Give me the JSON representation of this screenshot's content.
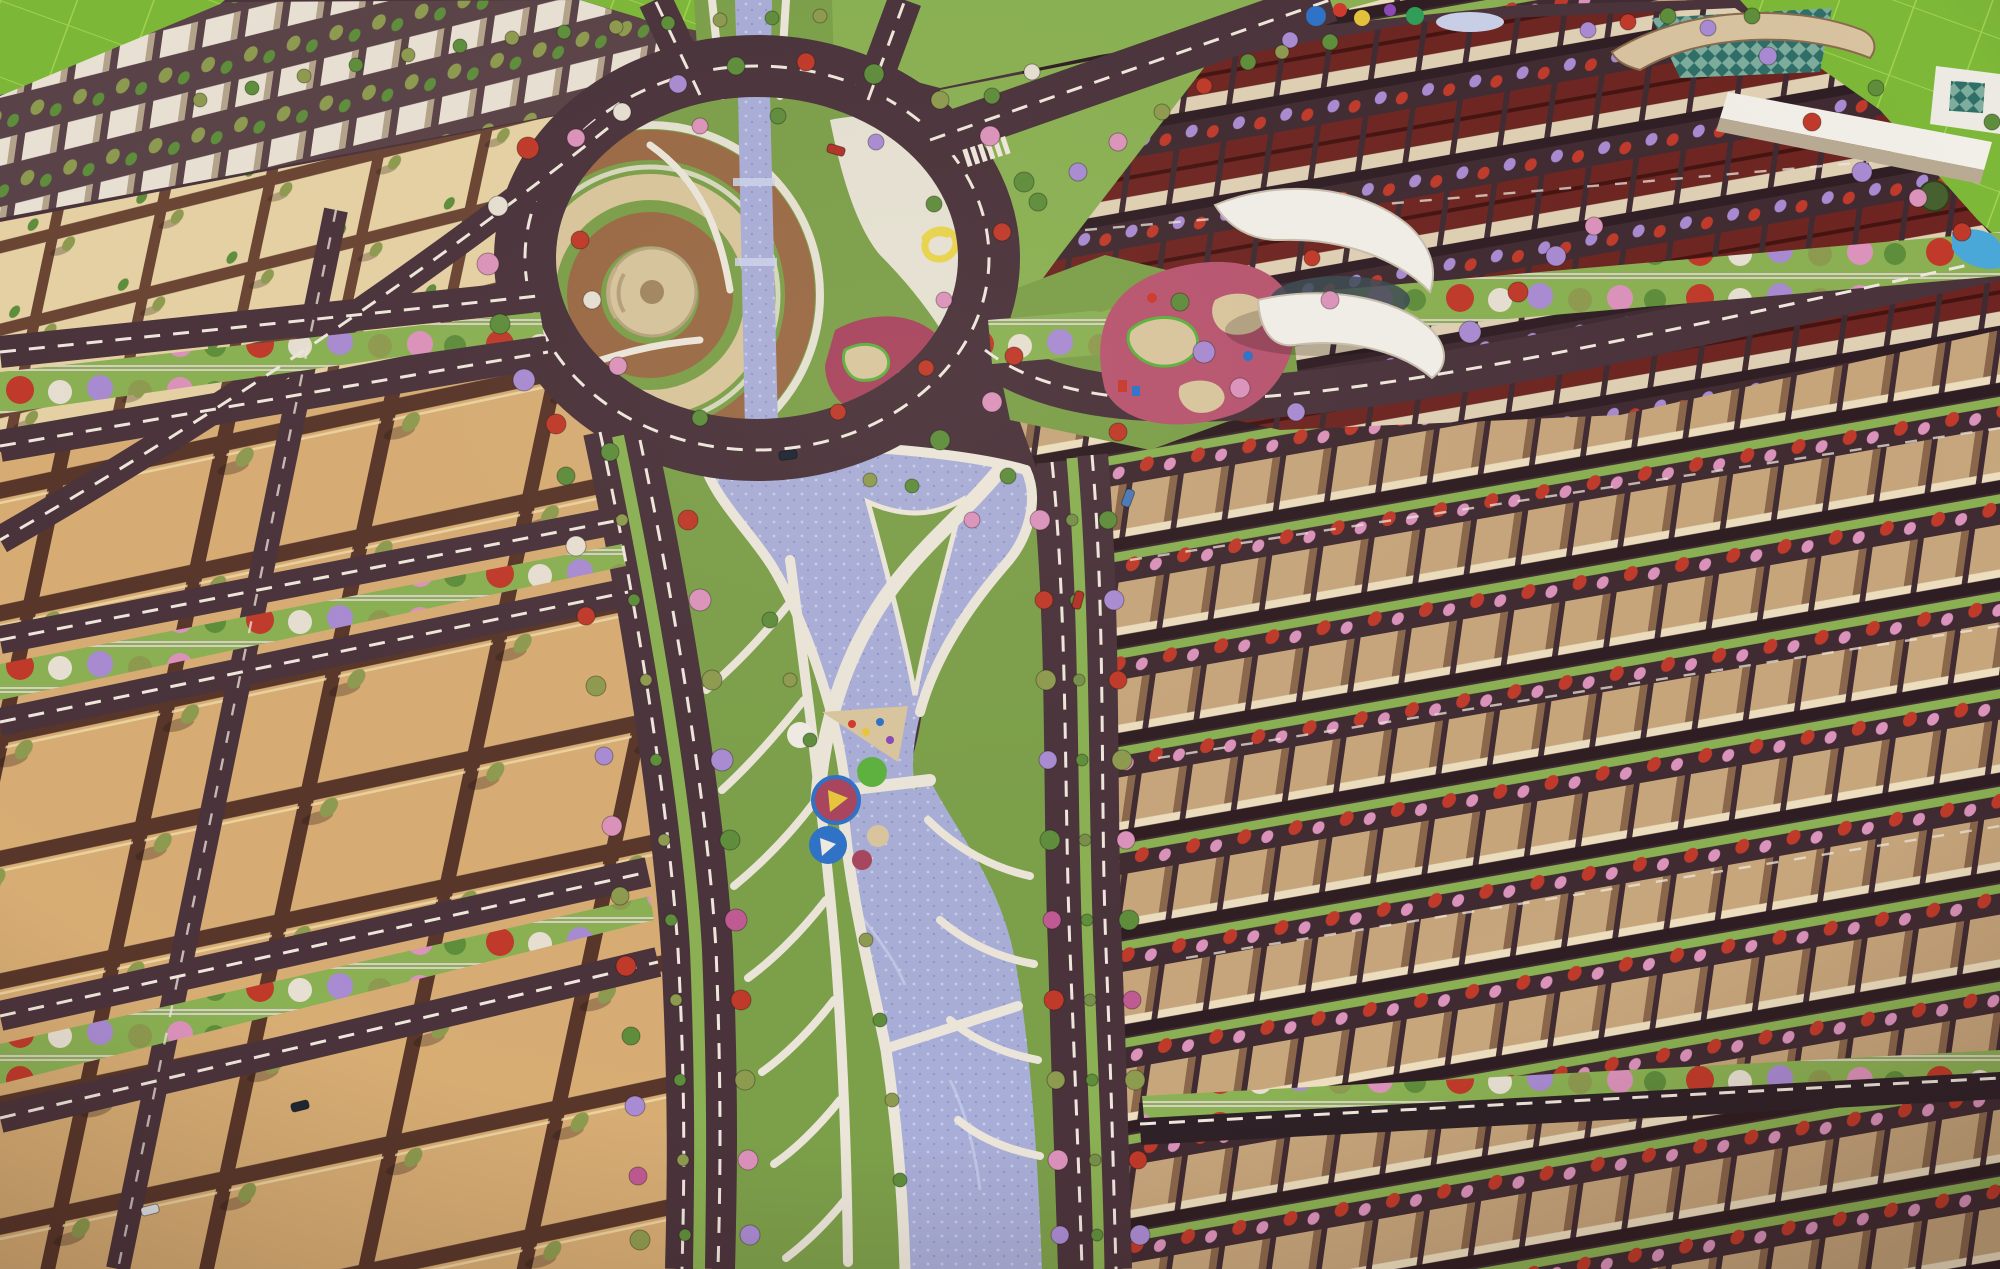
{
  "description": "Aerial 3D master-plan render of a township: central landscaped roundabout park crossed by a winding blue canal with white promenades, empty tan plot grids on the left, rows of flat-roofed tan villas on the right, red-roofed townhouses and a curved-canopy clubhouse at top right, green fields in the corners, tree-lined boulevards with flowering red, pink and purple trees.",
  "palette": {
    "road": "#4a333b",
    "roadDark": "#2e2127",
    "street": "#402b32",
    "dash": "#efe7dd",
    "plotTan": "#d7ad74",
    "plotLine": "#58362a",
    "plotLight": "#e6d2a4",
    "plotLineLight": "#6b4534",
    "canal": "#a9aed8",
    "canalLight": "#ced3ec",
    "canalDeep": "#8e94c6",
    "park": "#7ca04a",
    "lawn": "#8ab153",
    "field": "#7db838",
    "fieldLine": "#a3d24f",
    "pathWhite": "#ece6da",
    "ringBrown": "#9a6a45",
    "ringTan": "#d9c69c",
    "playMaroon": "#a8455f",
    "playPink": "#b85570",
    "sand": "#d9c69e",
    "playGreen": "#5cb23e",
    "villaRoof": "#c7a67c",
    "villaDark": "#8a674b",
    "villaFace": "#ecdebf",
    "roofRed": "#6e2521",
    "roofRedDark": "#451310",
    "wallCream": "#e0d1b5",
    "glassTeal": "#2f6f68",
    "roofCream": "#d8c3a0",
    "white": "#f2efe9",
    "treeGreen": "#5e8e3c",
    "treeOlive": "#8d9b4f",
    "treePalm": "#77904a",
    "treeRed": "#c03a2a",
    "treePink": "#dc93bc",
    "treePurple": "#a98bd3",
    "treeWhite": "#e7e0d2",
    "treeMagenta": "#c05a94",
    "carDark": "#1d2733",
    "carRed": "#b33127",
    "carBlue": "#4a7ab8",
    "carWhite": "#dfe3e8"
  },
  "scene": {
    "trees": [
      [
        566,
        476,
        9,
        "treeGreen"
      ],
      [
        576,
        546,
        10,
        "treeWhite"
      ],
      [
        586,
        616,
        9,
        "treeRed"
      ],
      [
        596,
        686,
        10,
        "treeOlive"
      ],
      [
        604,
        756,
        9,
        "treePurple"
      ],
      [
        612,
        826,
        10,
        "treePink"
      ],
      [
        620,
        896,
        9,
        "treeOlive"
      ],
      [
        626,
        966,
        10,
        "treeRed"
      ],
      [
        631,
        1036,
        9,
        "treeGreen"
      ],
      [
        635,
        1106,
        10,
        "treePurple"
      ],
      [
        638,
        1176,
        9,
        "treeMagenta"
      ],
      [
        640,
        1240,
        10,
        "treeOlive"
      ],
      [
        622,
        520,
        6,
        "treeOlive"
      ],
      [
        634,
        600,
        6,
        "treeGreen"
      ],
      [
        646,
        680,
        6,
        "treeOlive"
      ],
      [
        656,
        760,
        6,
        "treeGreen"
      ],
      [
        664,
        840,
        6,
        "treeOlive"
      ],
      [
        671,
        920,
        6,
        "treeGreen"
      ],
      [
        676,
        1000,
        6,
        "treeOlive"
      ],
      [
        680,
        1080,
        6,
        "treeGreen"
      ],
      [
        683,
        1160,
        6,
        "treeOlive"
      ],
      [
        685,
        1235,
        6,
        "treeGreen"
      ],
      [
        688,
        520,
        10,
        "treeRed"
      ],
      [
        700,
        600,
        11,
        "treePink"
      ],
      [
        712,
        680,
        10,
        "treeOlive"
      ],
      [
        722,
        760,
        11,
        "treePurple"
      ],
      [
        730,
        840,
        10,
        "treeGreen"
      ],
      [
        736,
        920,
        11,
        "treeMagenta"
      ],
      [
        741,
        1000,
        10,
        "treeRed"
      ],
      [
        745,
        1080,
        10,
        "treeOlive"
      ],
      [
        748,
        1160,
        10,
        "treePink"
      ],
      [
        750,
        1235,
        10,
        "treePurple"
      ],
      [
        1072,
        520,
        6,
        "treePalm"
      ],
      [
        1076,
        600,
        6,
        "treeGreen"
      ],
      [
        1079,
        680,
        6,
        "treePalm"
      ],
      [
        1082,
        760,
        6,
        "treeGreen"
      ],
      [
        1085,
        840,
        6,
        "treePalm"
      ],
      [
        1087,
        920,
        6,
        "treeGreen"
      ],
      [
        1090,
        1000,
        6,
        "treePalm"
      ],
      [
        1092,
        1080,
        6,
        "treeGreen"
      ],
      [
        1095,
        1160,
        6,
        "treePalm"
      ],
      [
        1097,
        1235,
        6,
        "treeGreen"
      ],
      [
        1040,
        520,
        10,
        "treePink"
      ],
      [
        1044,
        600,
        9,
        "treeRed"
      ],
      [
        1046,
        680,
        10,
        "treeOlive"
      ],
      [
        1048,
        760,
        9,
        "treePurple"
      ],
      [
        1050,
        840,
        10,
        "treeGreen"
      ],
      [
        1052,
        920,
        9,
        "treeMagenta"
      ],
      [
        1054,
        1000,
        10,
        "treeRed"
      ],
      [
        1056,
        1080,
        9,
        "treeOlive"
      ],
      [
        1058,
        1160,
        10,
        "treePink"
      ],
      [
        1060,
        1235,
        9,
        "treePurple"
      ],
      [
        1108,
        520,
        9,
        "treeGreen"
      ],
      [
        1114,
        600,
        10,
        "treePurple"
      ],
      [
        1118,
        680,
        9,
        "treeRed"
      ],
      [
        1122,
        760,
        10,
        "treeOlive"
      ],
      [
        1126,
        840,
        9,
        "treePink"
      ],
      [
        1129,
        920,
        10,
        "treeGreen"
      ],
      [
        1132,
        1000,
        9,
        "treeMagenta"
      ],
      [
        1135,
        1080,
        10,
        "treeOlive"
      ],
      [
        1138,
        1160,
        9,
        "treeRed"
      ],
      [
        1140,
        1235,
        10,
        "treePurple"
      ],
      [
        528,
        148,
        11,
        "treeRed"
      ],
      [
        498,
        206,
        10,
        "treeWhite"
      ],
      [
        488,
        264,
        11,
        "treePink"
      ],
      [
        500,
        324,
        10,
        "treeGreen"
      ],
      [
        524,
        380,
        11,
        "treePurple"
      ],
      [
        556,
        424,
        10,
        "treeRed"
      ],
      [
        610,
        452,
        9,
        "treeGreen"
      ],
      [
        940,
        440,
        10,
        "treeGreen"
      ],
      [
        992,
        402,
        10,
        "treePink"
      ],
      [
        1014,
        356,
        9,
        "treeRed"
      ],
      [
        1024,
        182,
        10,
        "treeGreen"
      ],
      [
        990,
        136,
        10,
        "treePink"
      ],
      [
        940,
        100,
        9,
        "treeOlive"
      ],
      [
        874,
        74,
        10,
        "treeGreen"
      ],
      [
        806,
        62,
        9,
        "treeRed"
      ],
      [
        736,
        66,
        9,
        "treeGreen"
      ],
      [
        678,
        84,
        9,
        "treePurple"
      ],
      [
        622,
        112,
        9,
        "treeWhite"
      ],
      [
        576,
        138,
        9,
        "treePink"
      ],
      [
        580,
        240,
        9,
        "treeRed"
      ],
      [
        592,
        300,
        9,
        "treeWhite"
      ],
      [
        618,
        366,
        9,
        "treePink"
      ],
      [
        700,
        418,
        8,
        "treeGreen"
      ],
      [
        838,
        412,
        8,
        "treeRed"
      ],
      [
        700,
        126,
        8,
        "treePink"
      ],
      [
        778,
        116,
        8,
        "treeGreen"
      ],
      [
        876,
        142,
        8,
        "treePurple"
      ],
      [
        934,
        204,
        8,
        "treeGreen"
      ],
      [
        944,
        300,
        8,
        "treePink"
      ],
      [
        926,
        368,
        8,
        "treeRed"
      ],
      [
        1002,
        232,
        9,
        "treeRed"
      ],
      [
        1038,
        202,
        9,
        "treeGreen"
      ],
      [
        1078,
        172,
        9,
        "treePurple"
      ],
      [
        1118,
        142,
        9,
        "treePink"
      ],
      [
        1162,
        112,
        8,
        "treeOlive"
      ],
      [
        1204,
        86,
        8,
        "treeRed"
      ],
      [
        1248,
        62,
        8,
        "treeGreen"
      ],
      [
        1290,
        40,
        8,
        "treePurple"
      ],
      [
        992,
        96,
        8,
        "treeGreen"
      ],
      [
        1032,
        72,
        8,
        "treeWhite"
      ],
      [
        1204,
        352,
        11,
        "treePurple"
      ],
      [
        1240,
        388,
        10,
        "treePink"
      ],
      [
        1470,
        332,
        11,
        "treePurple"
      ],
      [
        1518,
        292,
        10,
        "treeRed"
      ],
      [
        1556,
        256,
        10,
        "treePurple"
      ],
      [
        1180,
        302,
        9,
        "treeGreen"
      ],
      [
        1594,
        226,
        9,
        "treePink"
      ],
      [
        1768,
        56,
        9,
        "treePurple"
      ],
      [
        1812,
        122,
        9,
        "treeRed"
      ],
      [
        1862,
        172,
        10,
        "treePurple"
      ],
      [
        1918,
        198,
        9,
        "treePink"
      ],
      [
        1962,
        232,
        9,
        "treeRed"
      ],
      [
        1752,
        16,
        8,
        "treeGreen"
      ],
      [
        1992,
        122,
        8,
        "treeGreen"
      ],
      [
        1876,
        88,
        8,
        "treeGreen"
      ],
      [
        200,
        100,
        7,
        "treeOlive"
      ],
      [
        252,
        88,
        7,
        "treeGreen"
      ],
      [
        304,
        76,
        7,
        "treeOlive"
      ],
      [
        356,
        65,
        7,
        "treeGreen"
      ],
      [
        408,
        55,
        7,
        "treeOlive"
      ],
      [
        460,
        46,
        7,
        "treeGreen"
      ],
      [
        512,
        38,
        7,
        "treeOlive"
      ],
      [
        564,
        32,
        7,
        "treeGreen"
      ],
      [
        616,
        27,
        7,
        "treeOlive"
      ],
      [
        668,
        23,
        7,
        "treeGreen"
      ],
      [
        720,
        20,
        7,
        "treeOlive"
      ],
      [
        772,
        18,
        7,
        "treeGreen"
      ],
      [
        820,
        16,
        7,
        "treeOlive"
      ],
      [
        1330,
        42,
        8,
        "treeGreen"
      ],
      [
        1588,
        30,
        8,
        "treePurple"
      ],
      [
        1628,
        22,
        8,
        "treeRed"
      ],
      [
        1668,
        16,
        8,
        "treeGreen"
      ],
      [
        1708,
        28,
        8,
        "treePurple"
      ],
      [
        1282,
        52,
        7,
        "treeOlive"
      ],
      [
        1118,
        432,
        9,
        "treeRed"
      ],
      [
        1296,
        412,
        9,
        "treePurple"
      ],
      [
        1330,
        300,
        9,
        "treePink"
      ],
      [
        1312,
        258,
        8,
        "treeRed"
      ],
      [
        1008,
        476,
        8,
        "treeGreen"
      ],
      [
        972,
        520,
        8,
        "treePink"
      ],
      [
        912,
        486,
        7,
        "treeGreen"
      ],
      [
        870,
        480,
        7,
        "treeOlive"
      ],
      [
        770,
        620,
        8,
        "treeGreen"
      ],
      [
        790,
        680,
        7,
        "treeOlive"
      ],
      [
        810,
        740,
        7,
        "treeGreen"
      ],
      [
        866,
        940,
        7,
        "treeOlive"
      ],
      [
        880,
        1020,
        7,
        "treeGreen"
      ],
      [
        892,
        1100,
        7,
        "treeOlive"
      ],
      [
        900,
        1180,
        7,
        "treeGreen"
      ]
    ],
    "cars": [
      [
        788,
        455,
        -8,
        "carDark"
      ],
      [
        836,
        150,
        16,
        "carRed"
      ],
      [
        1128,
        498,
        -70,
        "carBlue"
      ],
      [
        1078,
        600,
        -75,
        "carRed"
      ],
      [
        300,
        1106,
        -14,
        "carDark"
      ],
      [
        150,
        1210,
        -14,
        "carWhite"
      ]
    ]
  }
}
